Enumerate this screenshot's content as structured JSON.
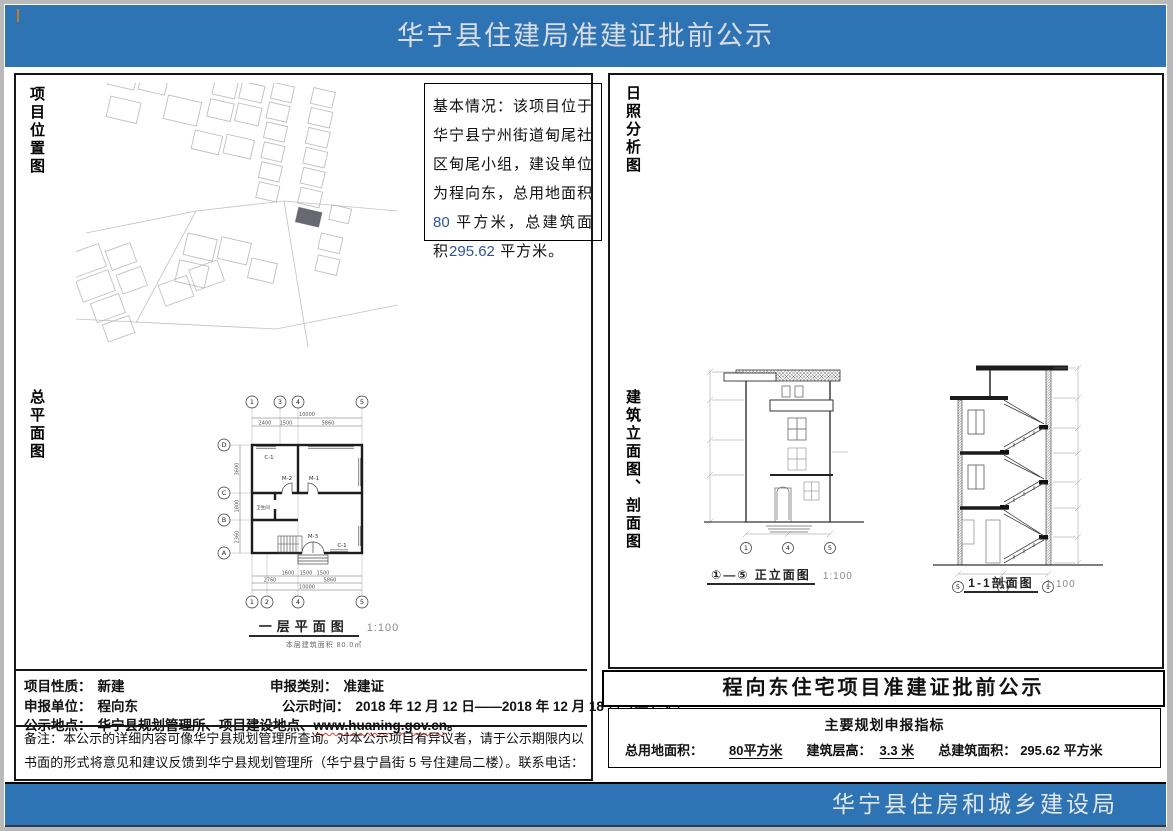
{
  "colors": {
    "banner_blue": "#2e74b5",
    "number_blue": "#2f5496",
    "drawing_line": "#333333",
    "spellcheck_red": "#e03c31"
  },
  "header": {
    "title": "华宁县住建局准建证批前公示"
  },
  "footer": {
    "organization": "华宁县住房和城乡建设局"
  },
  "left_panel": {
    "labels": {
      "location_map": "项目位置图",
      "site_plan": "总平面图"
    },
    "basic_info": {
      "lead": "基本情况：该项目位于华宁县宁州街道甸尾社区甸尾小组，建设单位为程向东，总用地面积",
      "land_area": "80",
      "mid": " 平方米，总建筑面积",
      "building_area": "295.62",
      "tail": " 平方米。"
    },
    "floor_plan": {
      "caption": "一层平面图",
      "scale": "1:100",
      "note": "本层建筑面积 80.0㎡",
      "grid_top": [
        "1",
        "3",
        "4",
        "5"
      ],
      "grid_bottom": [
        "1",
        "2",
        "4",
        "5"
      ],
      "grid_left": [
        "D",
        "C",
        "B",
        "A"
      ],
      "dims": {
        "top_total": "10000",
        "top": [
          "2400",
          "1500",
          "5860"
        ],
        "left": [
          "3600",
          "1800",
          "2360"
        ],
        "bottom": [
          "1600",
          "1500",
          "1500"
        ],
        "bottom2": [
          "2760",
          "5860"
        ],
        "bottom_total": "10000"
      },
      "rooms": {
        "window_top": "C-1",
        "door_left": "M-2",
        "door_right": "M-1",
        "bathroom": "卫生间",
        "entry_door": "M-3",
        "window_bottom": "C-1"
      }
    },
    "fields": {
      "nature_label": "项目性质：",
      "nature_value": "新建",
      "category_label": "申报类别：",
      "category_value": "准建证",
      "applicant_label": "申报单位：",
      "applicant_value": "程向东",
      "period_label": "公示时间：",
      "period_value": "2018 年 12 月 12 日——2018 年 12 月 18 日（共七天）",
      "location_label": "公示地点：",
      "location_value": "华宁县规划管理所、项目建设地点、",
      "location_url": "www.huaning.gov.cn",
      "location_suffix": "。",
      "remark": "备注：本公示的详细内容可像华宁县规划管理所查询。对本公示项目有异议者，请于公示期限内以书面的形式将意见和建议反馈到华宁县规划管理所（华宁县宁昌街 5 号住建局二楼）。联系电话：0877—5011057。"
    }
  },
  "right_panel": {
    "labels": {
      "sunshine": "日照分析图",
      "elevation_section": "建筑立面图、剖面图"
    },
    "elevation": {
      "caption": "①—⑤ 正立面图",
      "scale": "1:100",
      "grid": [
        "1",
        "4",
        "5"
      ]
    },
    "section": {
      "caption": "1-1剖面图",
      "scale": "1:100",
      "grid": [
        "5",
        "4",
        "1"
      ]
    },
    "notice_title": "程向东住宅项目准建证批前公示",
    "indicators": {
      "title": "主要规划申报指标",
      "land_label": "总用地面积：",
      "land_value": "80平方米",
      "floor_height_label": "建筑层高：",
      "floor_height_value": "3.3 米",
      "area_label": "总建筑面积：",
      "area_value": "295.62 平方米"
    }
  }
}
